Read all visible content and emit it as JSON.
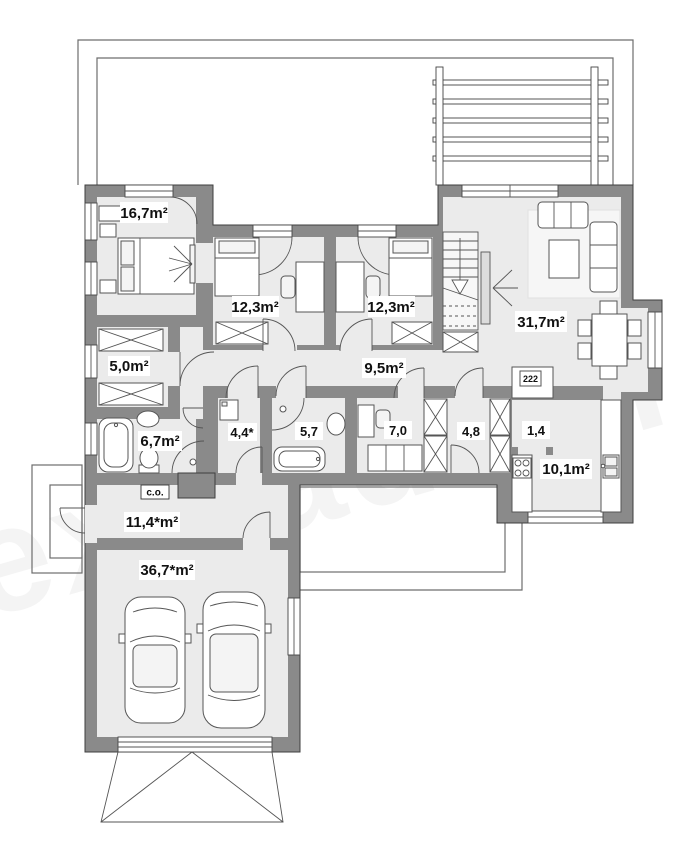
{
  "plan": {
    "watermark": "extradom",
    "rooms": [
      {
        "key": "bedroom-1",
        "label": "16,7m²"
      },
      {
        "key": "bedroom-2",
        "label": "12,3m²"
      },
      {
        "key": "bedroom-3",
        "label": "12,3m²"
      },
      {
        "key": "closet",
        "label": "5,0m²"
      },
      {
        "key": "hallway",
        "label": "9,5m²"
      },
      {
        "key": "bathroom-1",
        "label": "6,7m²"
      },
      {
        "key": "vestibule",
        "label": "4,4*"
      },
      {
        "key": "bathroom-2",
        "label": "5,7"
      },
      {
        "key": "office",
        "label": "7,0"
      },
      {
        "key": "hall",
        "label": "4,8"
      },
      {
        "key": "pantry",
        "label": "1,4"
      },
      {
        "key": "kitchen",
        "label": "10,1m²"
      },
      {
        "key": "living-room",
        "label": "31,7m²"
      },
      {
        "key": "utility-room",
        "label": "11,4*m²"
      },
      {
        "key": "garage",
        "label": "36,7*m²"
      }
    ],
    "annotations": {
      "boiler": "c.o.",
      "appliance": "222"
    }
  }
}
